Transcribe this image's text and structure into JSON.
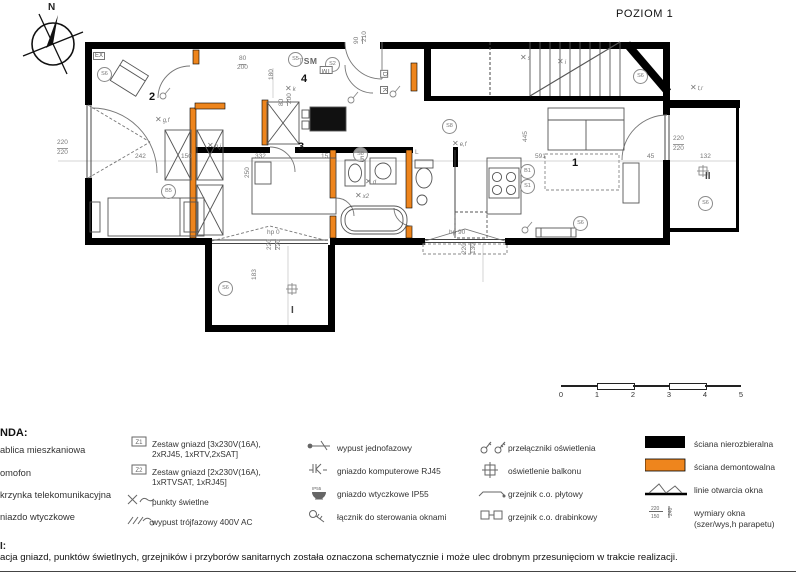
{
  "title": "POZIOM 1",
  "compass": {
    "label": "N"
  },
  "colors": {
    "wall_black": "#000000",
    "wall_orange": "#EE851D"
  },
  "plan": {
    "rooms": [
      {
        "t": "1",
        "x": 517,
        "y": 128,
        "k": "room"
      },
      {
        "t": "2",
        "x": 94,
        "y": 62,
        "k": "room"
      },
      {
        "t": "3",
        "x": 243,
        "y": 112,
        "k": "room"
      },
      {
        "t": "4",
        "x": 246,
        "y": 44,
        "k": "room"
      },
      {
        "t": "5",
        "x": 305,
        "y": 126,
        "k": "sub"
      },
      {
        "t": "I",
        "x": 236,
        "y": 276,
        "k": "bal"
      },
      {
        "t": "II",
        "x": 650,
        "y": 142,
        "k": "bal"
      },
      {
        "t": "TSM",
        "x": 243,
        "y": 27,
        "k": "tsm"
      }
    ],
    "dimensions": [
      {
        "t": "80",
        "x": 184,
        "y": 26,
        "u": 1
      },
      {
        "t": "200",
        "x": 182,
        "y": 35
      },
      {
        "t": "90",
        "x": 299,
        "y": 14,
        "r": 1,
        "u": 1
      },
      {
        "t": "210",
        "x": 307,
        "y": 12,
        "r": 1
      },
      {
        "t": "80",
        "x": 224,
        "y": 76,
        "r": 1,
        "u": 1
      },
      {
        "t": "200",
        "x": 232,
        "y": 74,
        "r": 1
      },
      {
        "t": "180",
        "x": 214,
        "y": 50,
        "r": 1
      },
      {
        "t": "220",
        "x": 2,
        "y": 110,
        "u": 1
      },
      {
        "t": "220",
        "x": 2,
        "y": 120
      },
      {
        "t": "242",
        "x": 80,
        "y": 124
      },
      {
        "t": "150",
        "x": 126,
        "y": 124
      },
      {
        "t": "332",
        "x": 200,
        "y": 124
      },
      {
        "t": "15",
        "x": 266,
        "y": 124
      },
      {
        "t": "250",
        "x": 190,
        "y": 148,
        "r": 1
      },
      {
        "t": "445",
        "x": 468,
        "y": 112,
        "r": 1
      },
      {
        "t": "591",
        "x": 480,
        "y": 124
      },
      {
        "t": "45",
        "x": 592,
        "y": 124
      },
      {
        "t": "220",
        "x": 618,
        "y": 106,
        "u": 1
      },
      {
        "t": "220",
        "x": 618,
        "y": 116
      },
      {
        "t": "132",
        "x": 645,
        "y": 124
      },
      {
        "t": "220",
        "x": 212,
        "y": 220,
        "r": 1,
        "u": 1
      },
      {
        "t": "220",
        "x": 221,
        "y": 220,
        "r": 1
      },
      {
        "t": "183",
        "x": 197,
        "y": 250,
        "r": 1
      },
      {
        "t": "220",
        "x": 407,
        "y": 224,
        "r": 1,
        "u": 1
      },
      {
        "t": "130",
        "x": 416,
        "y": 224,
        "r": 1
      },
      {
        "t": "hp 90",
        "x": 394,
        "y": 200
      },
      {
        "t": "hp 0",
        "x": 212,
        "y": 200
      },
      {
        "t": "L",
        "x": 360,
        "y": 120
      }
    ],
    "circles": [
      {
        "t": "S6",
        "x": 42,
        "y": 37
      },
      {
        "t": "S5",
        "x": 233,
        "y": 22
      },
      {
        "t": "S2",
        "x": 270,
        "y": 27
      },
      {
        "t": "S8",
        "x": 387,
        "y": 89
      },
      {
        "t": "B5",
        "x": 106,
        "y": 154
      },
      {
        "t": "S6",
        "x": 578,
        "y": 39
      },
      {
        "t": "B1",
        "x": 465,
        "y": 134
      },
      {
        "t": "S1",
        "x": 465,
        "y": 149
      },
      {
        "t": "S8",
        "x": 298,
        "y": 117
      },
      {
        "t": "S6",
        "x": 518,
        "y": 186
      },
      {
        "t": "S6",
        "x": 643,
        "y": 166
      },
      {
        "t": "S6",
        "x": 163,
        "y": 251
      }
    ],
    "boxes": [
      {
        "t": "EX",
        "x": 38,
        "y": 22
      },
      {
        "t": "TM",
        "x": 265,
        "y": 36,
        "r": 180
      },
      {
        "t": "D",
        "x": 325,
        "y": 40,
        "r": 90
      },
      {
        "t": "K",
        "x": 325,
        "y": 56,
        "r": 90
      }
    ],
    "lights": [
      {
        "t": "k",
        "x": 230,
        "y": 55
      },
      {
        "t": "g,f",
        "x": 100,
        "y": 86
      },
      {
        "t": "h,j",
        "x": 152,
        "y": 112
      },
      {
        "t": "e,f",
        "x": 397,
        "y": 110
      },
      {
        "t": "s",
        "x": 465,
        "y": 24
      },
      {
        "t": "d",
        "x": 310,
        "y": 148
      },
      {
        "t": "x2",
        "x": 300,
        "y": 162
      },
      {
        "t": "i",
        "x": 502,
        "y": 28
      },
      {
        "t": "t,r",
        "x": 635,
        "y": 54
      }
    ]
  },
  "scale_bar": {
    "ticks": [
      "0",
      "1",
      "2",
      "3",
      "4",
      "5"
    ]
  },
  "legend": {
    "title": "NDA:",
    "col1": [
      {
        "label": "ablica mieszkaniowa"
      },
      {
        "label": "omofon"
      },
      {
        "label": "krzynka telekomunikacyjna"
      },
      {
        "label": "niazdo wtyczkowe"
      }
    ],
    "col2": [
      {
        "icon": "socket-z",
        "icon_text": "Z1",
        "label": "Zestaw gniazd [3x230V(16A),\n2xRJ45, 1xRTV,2xSAT]"
      },
      {
        "icon": "socket-z",
        "icon_text": "Z2",
        "label": "Zestaw gniazd [2x230V(16A),\n1xRTVSAT, 1xRJ45]"
      },
      {
        "icon": "light-points",
        "label": "punkty świetlne"
      },
      {
        "icon": "three-phase",
        "label": "wypust trójfazowy 400V AC"
      }
    ],
    "col3": [
      {
        "icon": "single-phase",
        "label": "wypust jednofazowy"
      },
      {
        "icon": "rj45",
        "label": "gniazdo komputerowe RJ45"
      },
      {
        "icon": "ip55",
        "label": "gniazdo wtyczkowe IP55"
      },
      {
        "icon": "window-control",
        "label": "łącznik do sterowania oknami"
      }
    ],
    "col4": [
      {
        "icon": "switches",
        "label": "przełączniki oświetlenia"
      },
      {
        "icon": "balcony-light",
        "label": "oświetlenie balkonu"
      },
      {
        "icon": "panel-radiator",
        "label": "grzejnik c.o. płytowy"
      },
      {
        "icon": "ladder-radiator",
        "label": "grzejnik c.o. drabinkowy"
      }
    ],
    "col5": [
      {
        "icon": "wall-black",
        "label": "ściana nierozbieralna"
      },
      {
        "icon": "wall-orange",
        "label": "ściana demontowalna"
      },
      {
        "icon": "window-open",
        "label": "linie otwarcia okna"
      },
      {
        "icon": "window-dims",
        "label": "wymiary okna\n(szer/wys,h parapetu)"
      }
    ]
  },
  "notes": {
    "heading": "I:",
    "body": "acja gniazd, punktów świetlnych, grzejników i przyborów sanitarnych została oznaczona schematycznie i może ulec drobnym przesunięciom w trakcie realizacji."
  }
}
